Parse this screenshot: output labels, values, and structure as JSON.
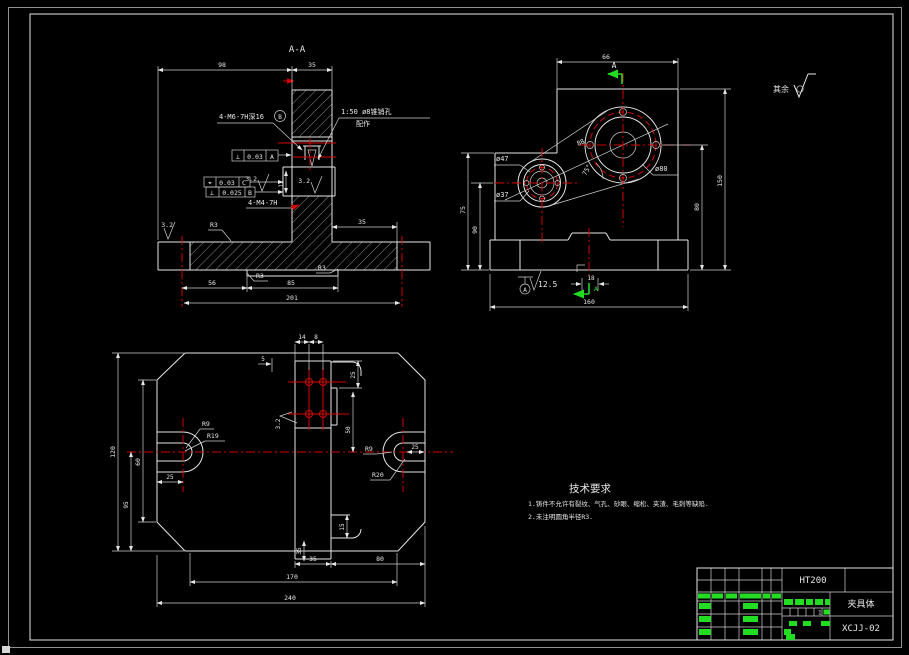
{
  "colors": {
    "background": "#000000",
    "line": "#e6e6e6",
    "centerline": "#d40000",
    "highlight": "#22dd22"
  },
  "corner_note": {
    "label": "其余"
  },
  "section_view": {
    "title": "A-A",
    "callout_m6": "4-M6-7H深16",
    "balloon_b": "B",
    "taper_note_line1": "1:50 ø8锥销孔",
    "taper_note_line2": "配作",
    "fcf_perp_a": {
      "sym": "⊥",
      "tol": "0.03",
      "datum": "A"
    },
    "fcf_pos_c": {
      "sym": "⌖",
      "tol": "0.03",
      "datum": "C"
    },
    "fcf_perp_b": {
      "sym": "⊥",
      "tol": "0.025",
      "datum": "B"
    },
    "callout_m4": "4-M4-7H",
    "ra1": "3.2",
    "ra2": "3.2",
    "ra3": "3.2",
    "r3a": "R3",
    "r3b": "R3",
    "r3c": "R3",
    "dims": {
      "top_left": "98",
      "top_right": "35",
      "right_step": "35",
      "slot": "12",
      "bottom_left": "56",
      "bottom_right": "85",
      "overall": "201"
    }
  },
  "side_view": {
    "section_arrow_top": "A",
    "section_arrow_bottom": "A",
    "dia_large": "ø80",
    "dia_mid": "ø47",
    "dia_small": "ø37",
    "ra": "12.5",
    "datum": "A",
    "dims": {
      "top": "66",
      "left_outer": "75",
      "left_inner": "90",
      "right_inner": "80",
      "right_outer": "150",
      "bottom": "160",
      "base_center": "18",
      "centers": "88",
      "angle": "75°"
    }
  },
  "plan_view": {
    "r9_left": "R9",
    "r19": "R19",
    "r9_right": "R9",
    "r20": "R20",
    "ra": "3.2",
    "dims": {
      "top_a": "14",
      "top_b": "8",
      "left_gap": "5",
      "right_top": "25",
      "right_mid": "50",
      "right_bot": "15",
      "left_outer": "120",
      "left_mid": "60",
      "left_low": "95",
      "slot": "25",
      "slot_r": "25",
      "boss_v": "35",
      "bot_a": "35",
      "bot_b": "80",
      "bot_mid": "170",
      "bot_all": "240"
    }
  },
  "tech_req": {
    "title": "技术要求",
    "items": [
      "1.铸件不允许有裂纹、气孔、砂眼、缩松、夹渣、毛刺等缺陷.",
      "2.未注明圆角半径R3."
    ]
  },
  "title_block": {
    "material": "HT200",
    "part_name": "夹具体",
    "drawing_no": "XCJJ-02",
    "sheet_no": "1"
  }
}
